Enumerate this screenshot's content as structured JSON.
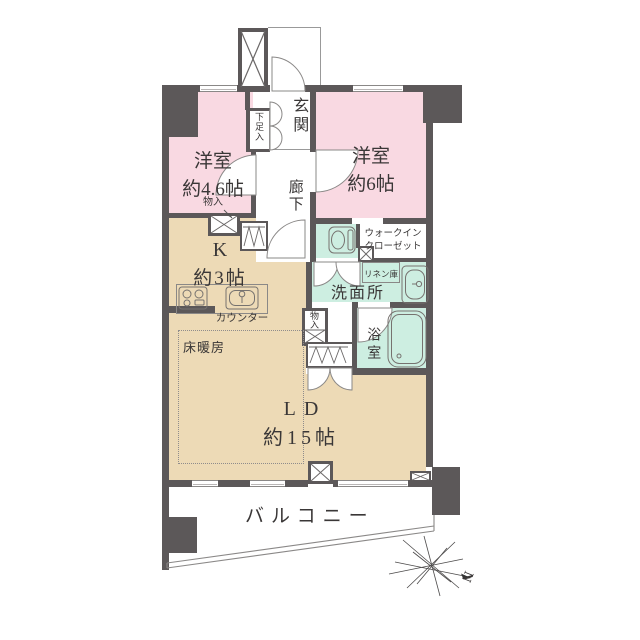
{
  "plan": {
    "rooms": {
      "bedroom_small": {
        "line1": "洋室",
        "line2": "約4.6帖"
      },
      "bedroom_large": {
        "line1": "洋室",
        "line2": "約6帖"
      },
      "entrance": {
        "label": "玄関"
      },
      "shoe_cabinet": {
        "label": "下足入"
      },
      "hallway": {
        "label": "廊下"
      },
      "kitchen": {
        "line1": "K",
        "line2": "約3帖"
      },
      "counter": {
        "label": "カウンター"
      },
      "storage_kitchen": {
        "label": "物入"
      },
      "storage_living": {
        "label": "物入"
      },
      "walk_in_closet": {
        "line1": "ウォークイン",
        "line2": "クローゼット"
      },
      "linen_cabinet": {
        "label": "リネン庫"
      },
      "washroom": {
        "label": "洗面所"
      },
      "bathroom": {
        "label": "浴室"
      },
      "floor_heating": {
        "label": "床暖房"
      },
      "living_dining": {
        "line1": "LD",
        "line2": "約15帖"
      },
      "balcony": {
        "label": "バルコニー"
      }
    },
    "compass": {
      "north_label": "N"
    },
    "colors": {
      "wall": "#5c5859",
      "bedroom_fill": "#f9d9e2",
      "wet_area_fill": "#cdeee1",
      "living_fill": "#eddab6",
      "outline": "#8a8887"
    }
  }
}
